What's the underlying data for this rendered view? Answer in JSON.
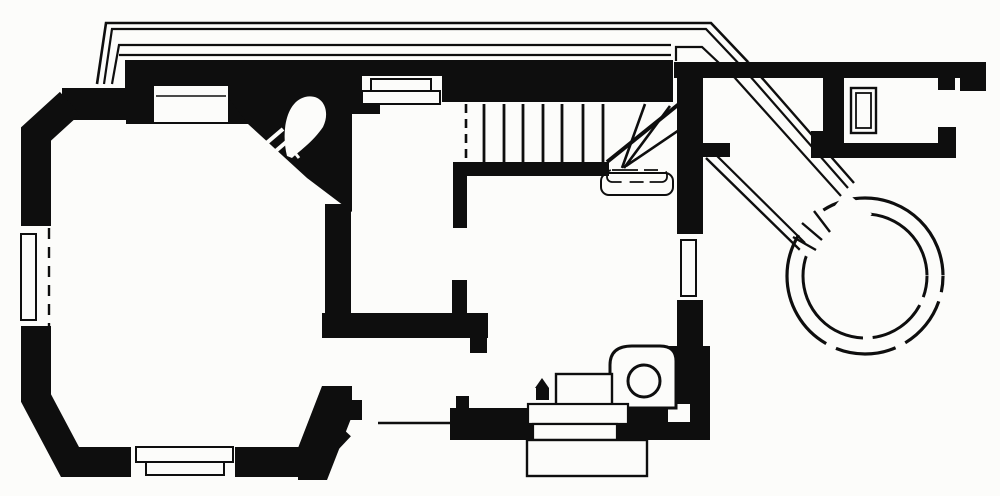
{
  "canvas": {
    "viewBox": "0 0 1000 496",
    "width": 1000,
    "height": 496
  },
  "colors": {
    "ink": "#0e0e0e",
    "paper": "#fcfcfa"
  },
  "figure": {
    "kind": "architectural-floor-plan",
    "style": "black ink line drawing, solid poché walls on white paper",
    "elements": [
      "veranda-with-parapet-lines",
      "principal-room-with-canted-corners",
      "left-wall-window",
      "bottom-wall-window",
      "chimney-breast-recess",
      "corner-fireplace",
      "entrance-steps-from-veranda",
      "entrance-hall",
      "dog-leg-staircase-with-winders",
      "under-stair-cupboard",
      "middle-room",
      "interior-partition-walls",
      "garden-door-opening",
      "back-steps-platform",
      "scullery-copper-with-round-top",
      "scullery-bench",
      "right-wall-window",
      "covered-diagonal-passage",
      "round-turret",
      "north-east-wing-rooms",
      "wing-fixture"
    ]
  }
}
